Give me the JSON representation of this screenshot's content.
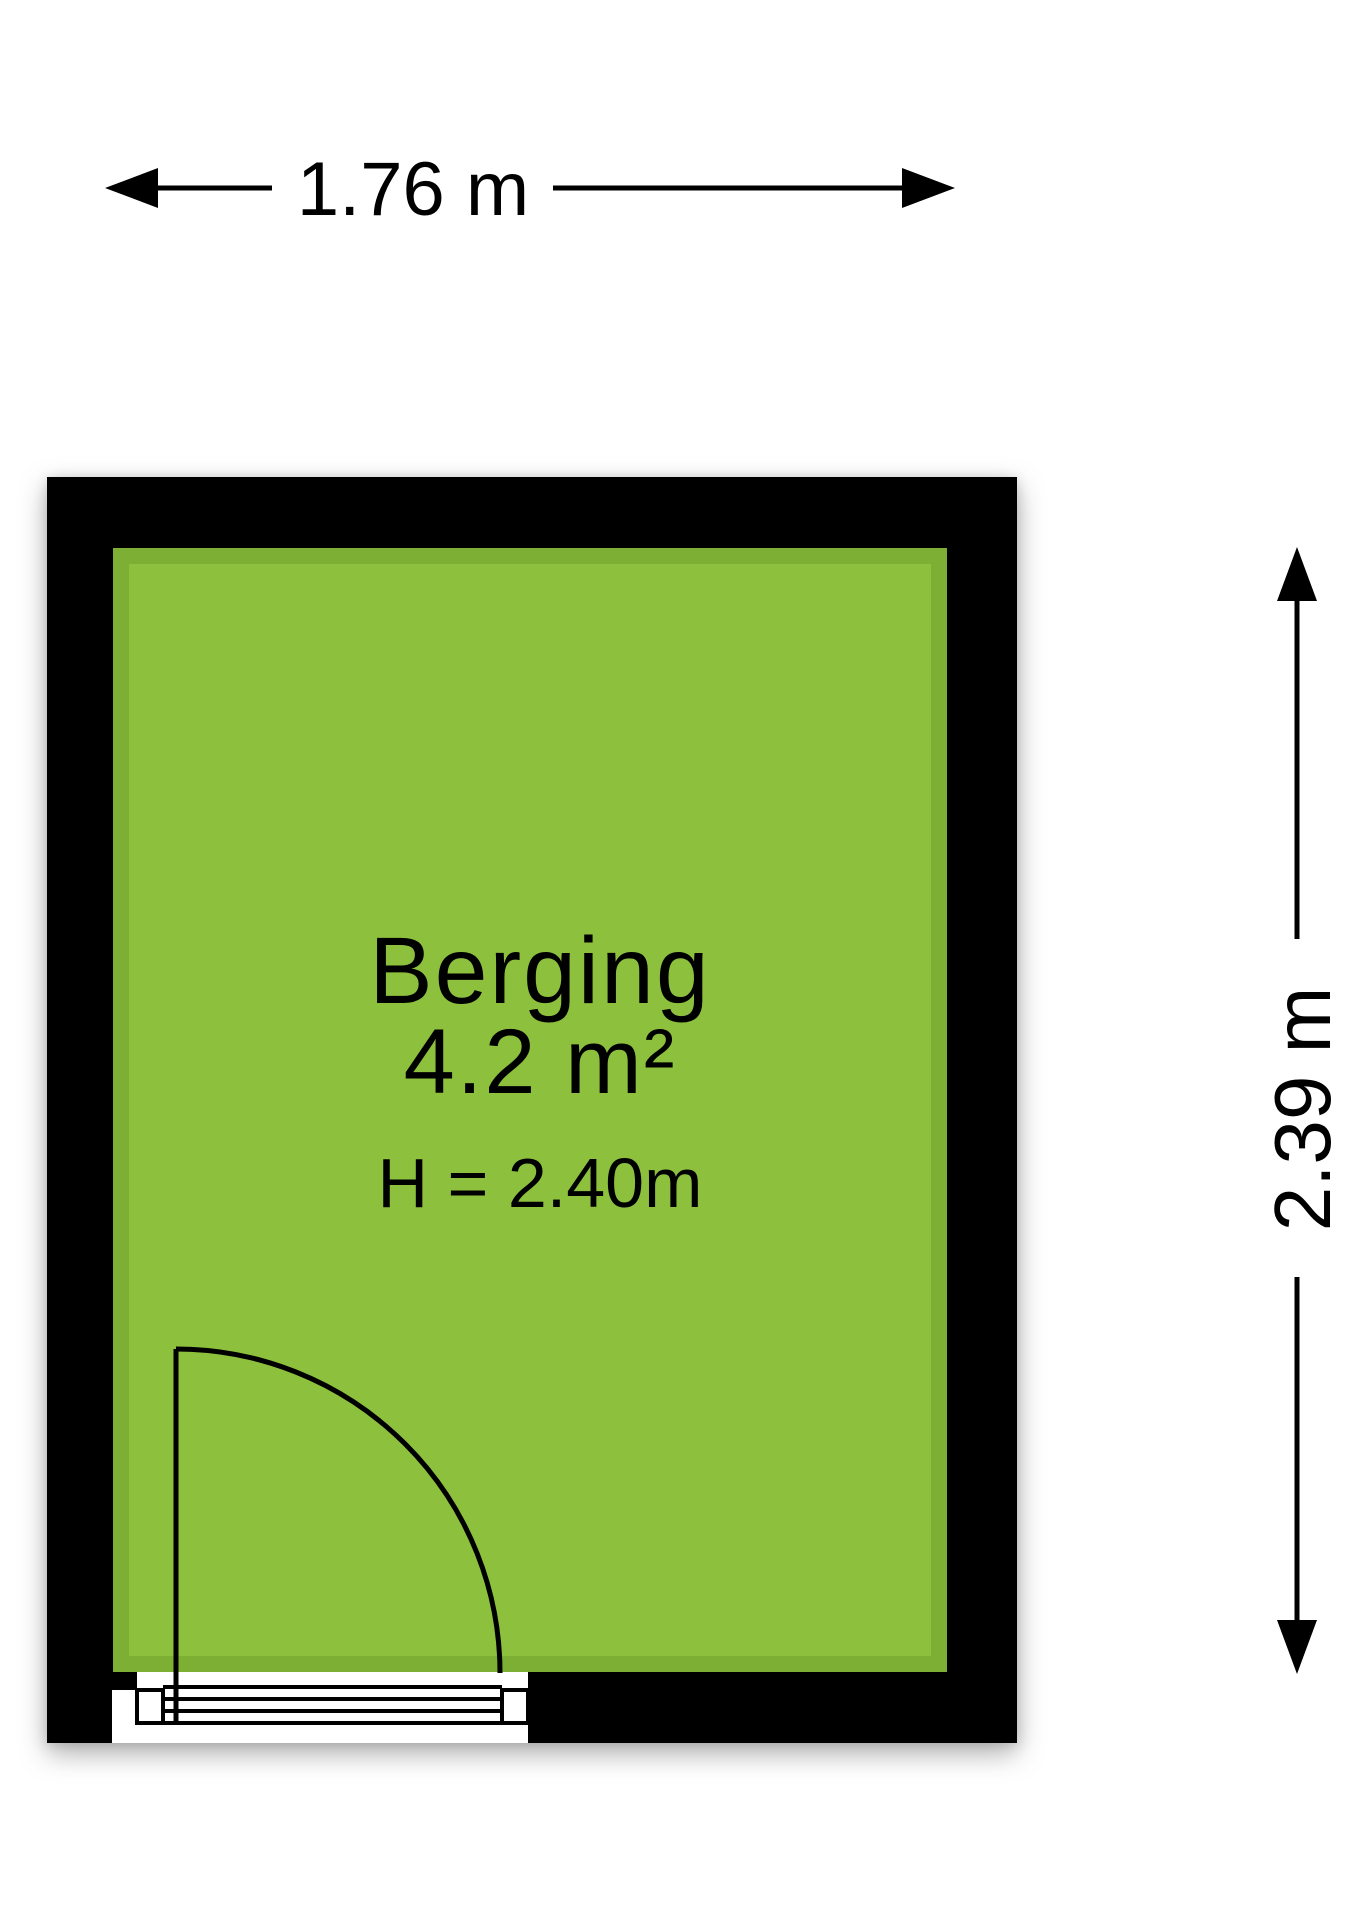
{
  "room": {
    "name": "Berging",
    "area": "4.2 m²",
    "ceiling_height": "H = 2.40m"
  },
  "dimensions": {
    "width": "1.76 m",
    "height": "2.39 m"
  },
  "colors": {
    "floor": "#8dc13d",
    "floor_shade": "#6f9e2e",
    "wall": "#000000",
    "dimension_lines": "#000000",
    "background": "#ffffff"
  }
}
